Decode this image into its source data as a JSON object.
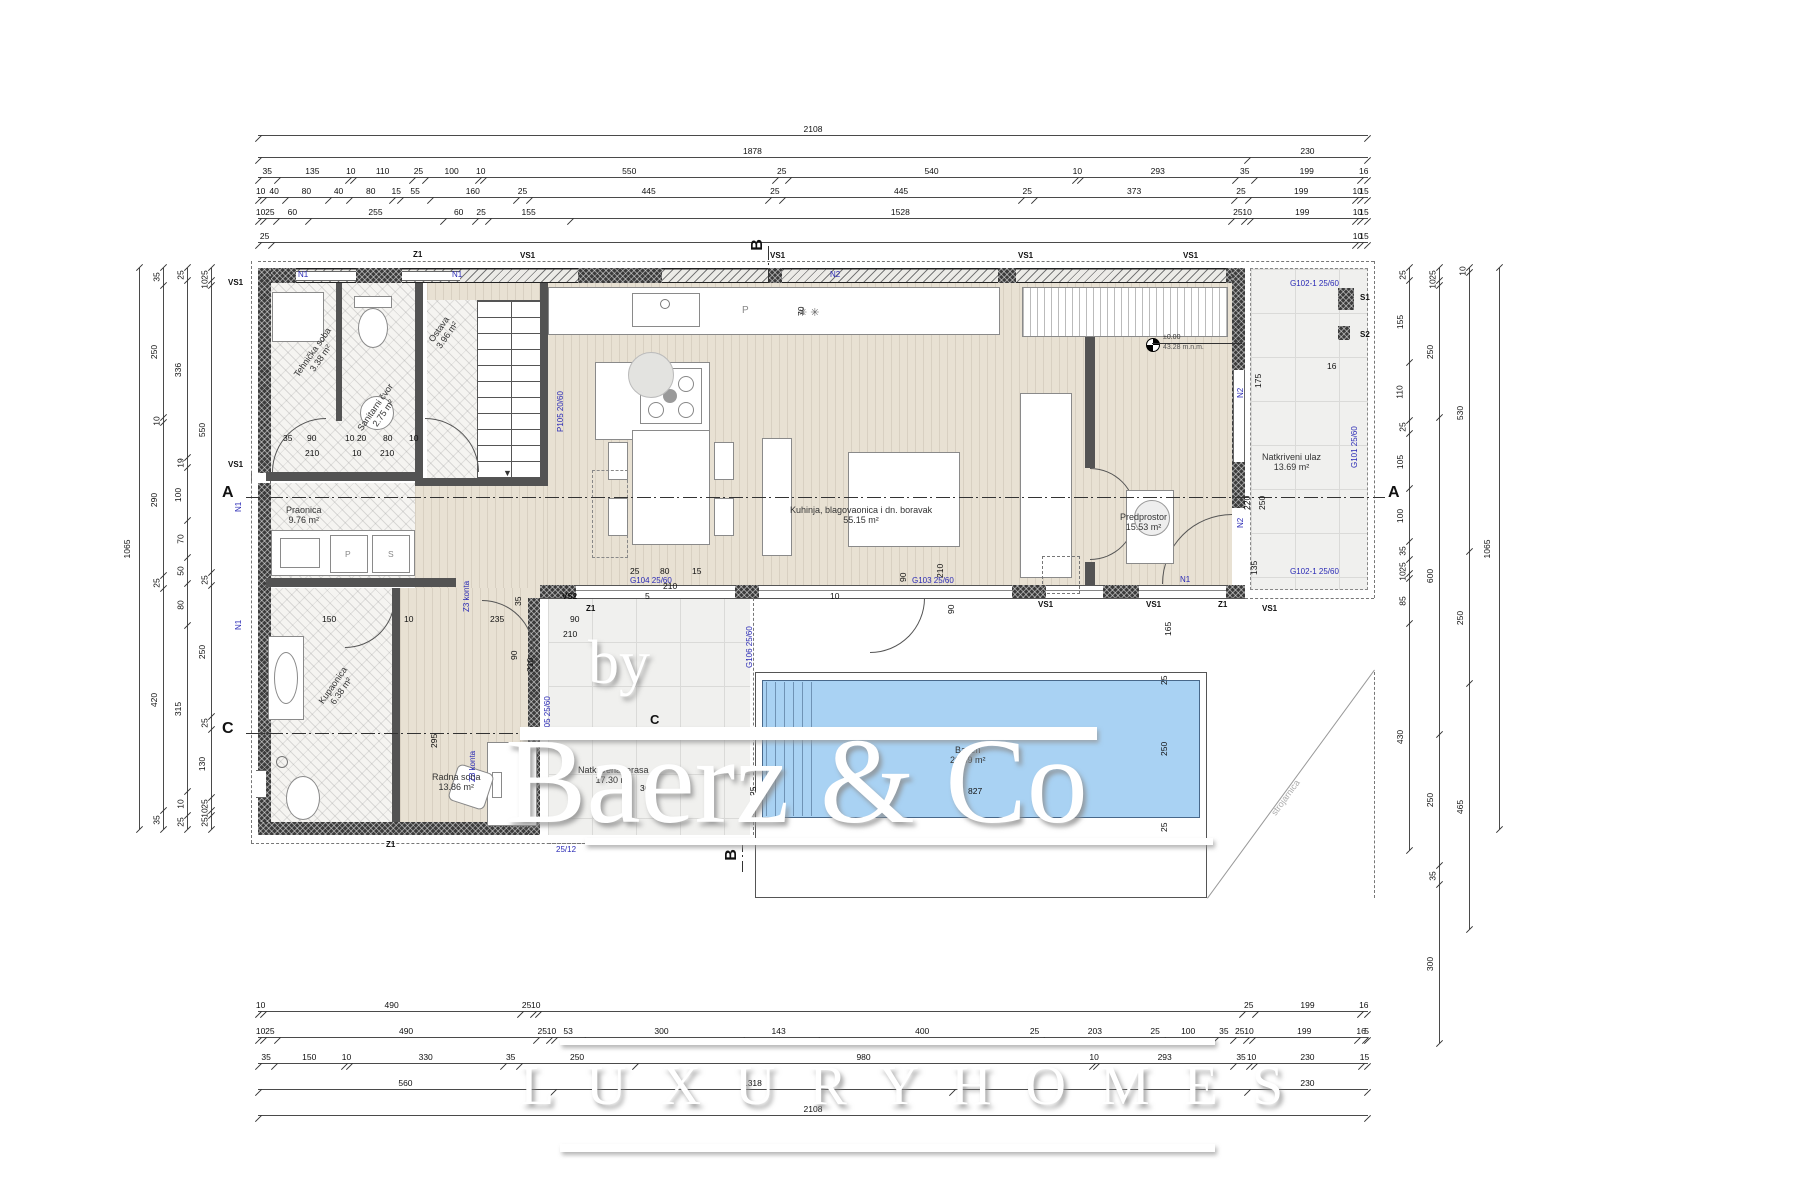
{
  "watermark": {
    "by": "by",
    "brand": "Baerz & Co",
    "tagline": "L U X U R Y   H O M E S"
  },
  "rooms": [
    {
      "name": "Tehnička soba",
      "area": "3.38 m²"
    },
    {
      "name": "Sanitarni čvor",
      "area": "2.75 m²"
    },
    {
      "name": "Ostava",
      "area": "3.96 m²"
    },
    {
      "name": "Praonica",
      "area": "9.76 m²"
    },
    {
      "name": "Kupaonica",
      "area": "6.38 m²"
    },
    {
      "name": "Radna soba",
      "area": "13.86 m²"
    },
    {
      "name": "Kuhinja, blagovaonica i dn. boravak",
      "area": "55.15 m²"
    },
    {
      "name": "Predprostor",
      "area": "15.53 m²"
    },
    {
      "name": "Natkriveni ulaz",
      "area": "13.69 m²"
    },
    {
      "name": "Natkrivena terasa",
      "area": "17.30 m²"
    },
    {
      "name": "Bazen",
      "area": "20.69 m²"
    }
  ],
  "level_marker": {
    "value": "±0.00",
    "elevation": "43.28 m.n.m."
  },
  "machine_room_label": "strojarnica",
  "section_labels": {
    "a": "A",
    "b": "B",
    "c": "C"
  },
  "wall_labels": {
    "vs1": "VS1",
    "vs2": "VS2",
    "z1": "Z1",
    "n1": "N1",
    "n2": "N2",
    "s1": "S1",
    "s2": "S2",
    "z3": "Z3 konta"
  },
  "opening_labels": {
    "p105": "P105 20/60",
    "g101": "G101 25/60",
    "g102": "G102-1 25/60",
    "g103": "G103 25/60",
    "g104": "G104 25/60",
    "g105": "G105 25/60",
    "g106": "G106 25/60",
    "small": "25/12"
  },
  "fixture_labels": {
    "p": "P",
    "s": "S"
  },
  "colors": {
    "pool": "#a9d2f3",
    "wood": "#e8e1d3",
    "tile": "#f0f0ee",
    "hatch_room": "#f5f4f1",
    "wall_dark": "#3b3b3b",
    "blue_label": "#2a2ab5"
  },
  "inner_dims": [
    "70",
    "175",
    "220",
    "250",
    "135",
    "35",
    "90",
    "10 20",
    "80",
    "10",
    "210",
    "10",
    "210",
    "25",
    "80",
    "15",
    "210",
    "5",
    "10",
    "90",
    "210",
    "150",
    "10",
    "235",
    "90",
    "210",
    "35",
    "90",
    "210",
    "295",
    "365",
    "827",
    "25",
    "250",
    "25",
    "165",
    "16",
    "90",
    "25"
  ],
  "chains": {
    "top": [
      [
        {
          "v": 2108,
          "t": "2108"
        }
      ],
      [
        {
          "v": 1878,
          "t": "1878"
        },
        {
          "v": 230,
          "t": "230"
        }
      ],
      [
        {
          "v": 35,
          "t": "35"
        },
        {
          "v": 135,
          "t": "135"
        },
        {
          "v": 10,
          "t": "10"
        },
        {
          "v": 110,
          "t": "110"
        },
        {
          "v": 25,
          "t": "25"
        },
        {
          "v": 100,
          "t": "100"
        },
        {
          "v": 10,
          "t": "10"
        },
        {
          "v": 550,
          "t": "550"
        },
        {
          "v": 25,
          "t": "25"
        },
        {
          "v": 540,
          "t": "540"
        },
        {
          "v": 10,
          "t": "10"
        },
        {
          "v": 293,
          "t": "293"
        },
        {
          "v": 35,
          "t": "35"
        },
        {
          "v": 199,
          "t": "199"
        },
        {
          "v": 16,
          "t": "16"
        }
      ],
      [
        {
          "v": 10,
          "t": "10"
        },
        {
          "v": 40,
          "t": "40"
        },
        {
          "v": 80,
          "t": "80"
        },
        {
          "v": 40,
          "t": "40"
        },
        {
          "v": 80,
          "t": "80"
        },
        {
          "v": 15,
          "t": "15"
        },
        {
          "v": 55,
          "t": "55"
        },
        {
          "v": 160,
          "t": "160"
        },
        {
          "v": 25,
          "t": "25"
        },
        {
          "v": 445,
          "t": "445"
        },
        {
          "v": 25,
          "t": "25"
        },
        {
          "v": 445,
          "t": "445"
        },
        {
          "v": 25,
          "t": "25"
        },
        {
          "v": 373,
          "t": "373"
        },
        {
          "v": 25,
          "t": "25"
        },
        {
          "v": 199,
          "t": "199"
        },
        {
          "v": 10,
          "t": "10"
        },
        {
          "v": 15,
          "t": "15"
        }
      ],
      [
        {
          "v": 10,
          "t": "10"
        },
        {
          "v": 25,
          "t": "25"
        },
        {
          "v": 60,
          "t": "60"
        },
        {
          "v": 255,
          "t": "255"
        },
        {
          "v": 60,
          "t": "60"
        },
        {
          "v": 25,
          "t": "25"
        },
        {
          "v": 155,
          "t": "155"
        },
        {
          "v": 1253,
          "t": "1528"
        },
        {
          "v": 25,
          "t": "25"
        },
        {
          "v": 10,
          "t": "10"
        },
        {
          "v": 199,
          "t": "199"
        },
        {
          "v": 10,
          "t": "10"
        },
        {
          "v": 15,
          "t": "15"
        }
      ],
      [
        {
          "v": 25,
          "t": "25"
        },
        {
          "v": 2058,
          "t": ""
        },
        {
          "v": 10,
          "t": "10"
        },
        {
          "v": 15,
          "t": "15"
        }
      ]
    ],
    "bottom": [
      [
        {
          "v": 10,
          "t": "10"
        },
        {
          "v": 490,
          "t": "490"
        },
        {
          "v": 25,
          "t": "25"
        },
        {
          "v": 10,
          "t": "10"
        },
        {
          "v": 1343,
          "t": ""
        },
        {
          "v": 25,
          "t": "25"
        },
        {
          "v": 199,
          "t": "199"
        },
        {
          "v": 16,
          "t": "16"
        }
      ],
      [
        {
          "v": 10,
          "t": "10"
        },
        {
          "v": 25,
          "t": "25"
        },
        {
          "v": 490,
          "t": "490"
        },
        {
          "v": 25,
          "t": "25"
        },
        {
          "v": 10,
          "t": "10"
        },
        {
          "v": 53,
          "t": "53"
        },
        {
          "v": 300,
          "t": "300"
        },
        {
          "v": 143,
          "t": "143"
        },
        {
          "v": 400,
          "t": "400"
        },
        {
          "v": 25,
          "t": "25"
        },
        {
          "v": 203,
          "t": "203"
        },
        {
          "v": 25,
          "t": "25"
        },
        {
          "v": 100,
          "t": "100"
        },
        {
          "v": 35,
          "t": "35"
        },
        {
          "v": 25,
          "t": "25"
        },
        {
          "v": 10,
          "t": "10"
        },
        {
          "v": 199,
          "t": "199"
        },
        {
          "v": 16,
          "t": "16"
        },
        {
          "v": 5,
          "t": "5"
        }
      ],
      [
        {
          "v": 35,
          "t": "35"
        },
        {
          "v": 150,
          "t": "150"
        },
        {
          "v": 10,
          "t": "10"
        },
        {
          "v": 330,
          "t": "330"
        },
        {
          "v": 35,
          "t": "35"
        },
        {
          "v": 250,
          "t": "250"
        },
        {
          "v": 980,
          "t": "980"
        },
        {
          "v": 10,
          "t": "10"
        },
        {
          "v": 293,
          "t": "293"
        },
        {
          "v": 35,
          "t": "35"
        },
        {
          "v": 10,
          "t": "10"
        },
        {
          "v": 230,
          "t": "230"
        },
        {
          "v": 15,
          "t": "15"
        }
      ],
      [
        {
          "v": 560,
          "t": "560"
        },
        {
          "v": 758,
          "t": "1318"
        },
        {
          "v": 560,
          "t": ""
        },
        {
          "v": 230,
          "t": "230"
        }
      ],
      [
        {
          "v": 2108,
          "t": "2108"
        }
      ]
    ],
    "left": [
      [
        {
          "v": 1065,
          "t": "1065"
        }
      ],
      [
        {
          "v": 35,
          "t": "35"
        },
        {
          "v": 250,
          "t": "250"
        },
        {
          "v": 10,
          "t": "10"
        },
        {
          "v": 290,
          "t": "290"
        },
        {
          "v": 25,
          "t": "25"
        },
        {
          "v": 420,
          "t": "420"
        },
        {
          "v": 35,
          "t": "35"
        }
      ],
      [
        {
          "v": 25,
          "t": "25"
        },
        {
          "v": 336,
          "t": "336"
        },
        {
          "v": 19,
          "t": "19"
        },
        {
          "v": 100,
          "t": "100"
        },
        {
          "v": 70,
          "t": "70"
        },
        {
          "v": 50,
          "t": "50"
        },
        {
          "v": 80,
          "t": "80"
        },
        {
          "v": 315,
          "t": "315"
        },
        {
          "v": 45,
          "t": "10"
        },
        {
          "v": 25,
          "t": "25"
        }
      ],
      [
        {
          "v": 25,
          "t": "25"
        },
        {
          "v": 10,
          "t": "10"
        },
        {
          "v": 550,
          "t": "550"
        },
        {
          "v": 25,
          "t": "25"
        },
        {
          "v": 250,
          "t": "250"
        },
        {
          "v": 25,
          "t": "25"
        },
        {
          "v": 130,
          "t": "130"
        },
        {
          "v": 25,
          "t": "25"
        },
        {
          "v": 10,
          "t": "10"
        },
        {
          "v": 25,
          "t": "25"
        }
      ]
    ],
    "right": [
      [
        {
          "v": 25,
          "t": "25"
        },
        {
          "v": 155,
          "t": "155"
        },
        {
          "v": 110,
          "t": "110"
        },
        {
          "v": 25,
          "t": "25"
        },
        {
          "v": 105,
          "t": "105"
        },
        {
          "v": 100,
          "t": "100"
        },
        {
          "v": 35,
          "t": "35"
        },
        {
          "v": 25,
          "t": "25"
        },
        {
          "v": 10,
          "t": "10"
        },
        {
          "v": 85,
          "t": "85"
        },
        {
          "v": 430,
          "t": "430"
        }
      ],
      [
        {
          "v": 25,
          "t": "25"
        },
        {
          "v": 10,
          "t": "10"
        },
        {
          "v": 250,
          "t": "250"
        },
        {
          "v": 600,
          "t": "600"
        },
        {
          "v": 250,
          "t": "250"
        },
        {
          "v": 35,
          "t": "35"
        },
        {
          "v": 300,
          "t": "300"
        }
      ],
      [
        {
          "v": 10,
          "t": "10"
        },
        {
          "v": 530,
          "t": "530"
        },
        {
          "v": 250,
          "t": "250"
        },
        {
          "v": 465,
          "t": "465"
        }
      ],
      [
        {
          "v": 1065,
          "t": "1065"
        }
      ]
    ],
    "corner": [
      [
        {
          "v": 41,
          "t": "41"
        },
        {
          "v": 50,
          "t": "50"
        },
        {
          "v": 20,
          "t": "20"
        },
        {
          "v": 16,
          "t": "16"
        }
      ]
    ]
  }
}
